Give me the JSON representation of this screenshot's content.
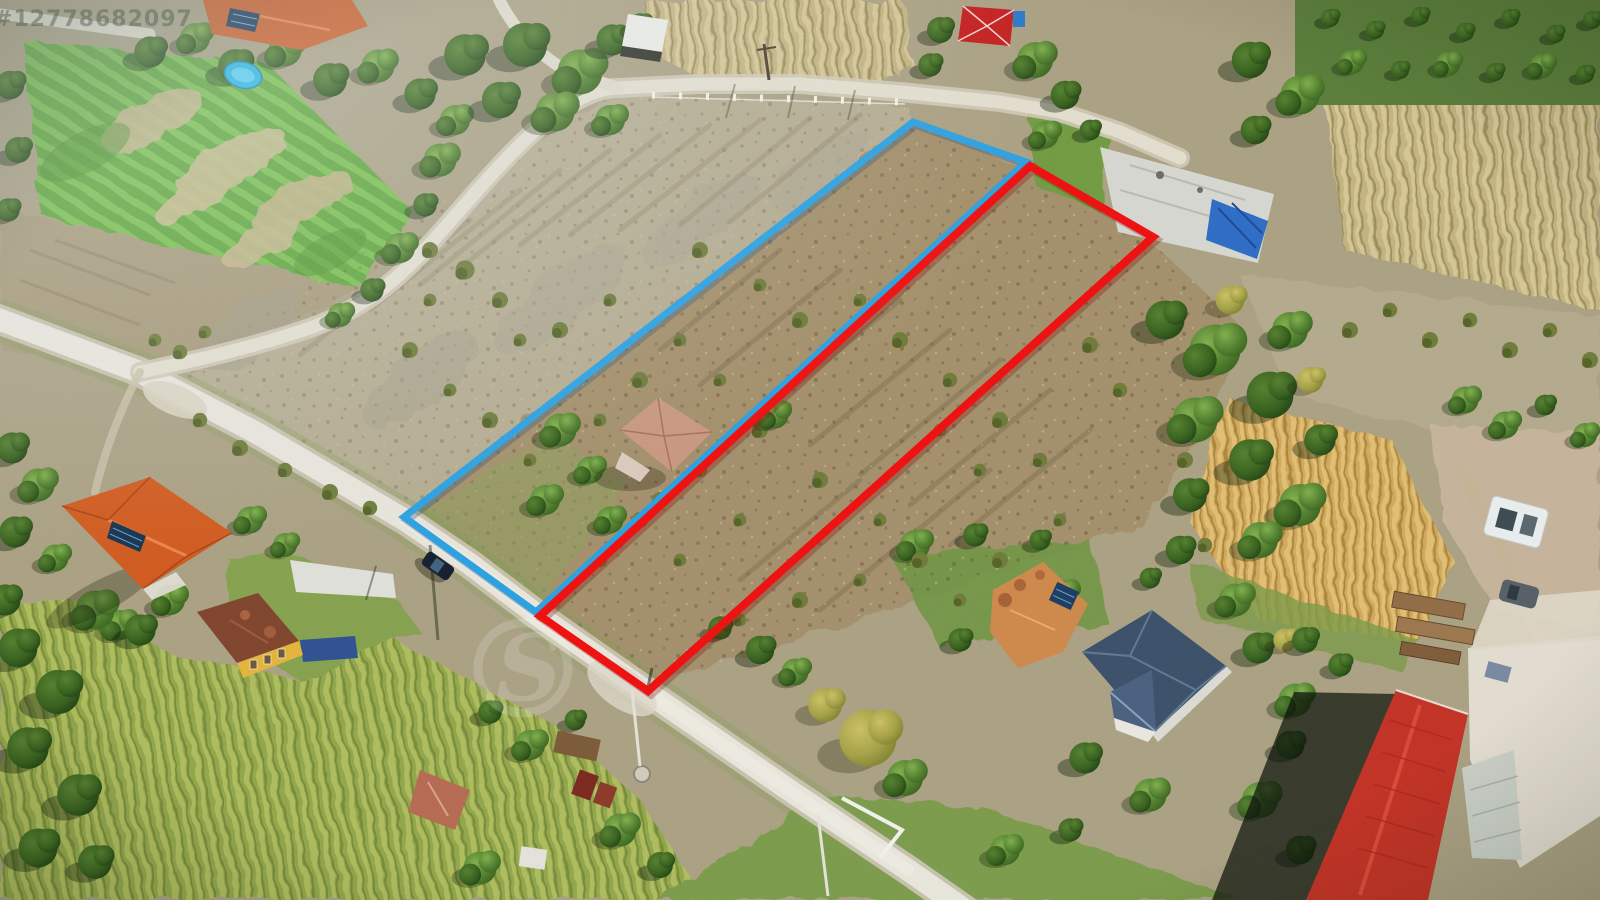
{
  "scene": {
    "type_label": "aerial-drone-photo",
    "subject": "rural land listing photo with two outlined parcels"
  },
  "watermark": {
    "listing_id": "#12778682097",
    "logo_letter": "S"
  },
  "parcels": {
    "blue": {
      "name": "left-parcel",
      "outline_color": "#2d9fe0",
      "shadow_color": "#1a4a78",
      "points": "913,122 1026,162 536,612 404,517"
    },
    "red": {
      "name": "right-parcel",
      "outline_color": "#ee1111",
      "shadow_color": "#7a0d0d",
      "points": "1030,166 1153,237 648,691 540,616"
    }
  }
}
